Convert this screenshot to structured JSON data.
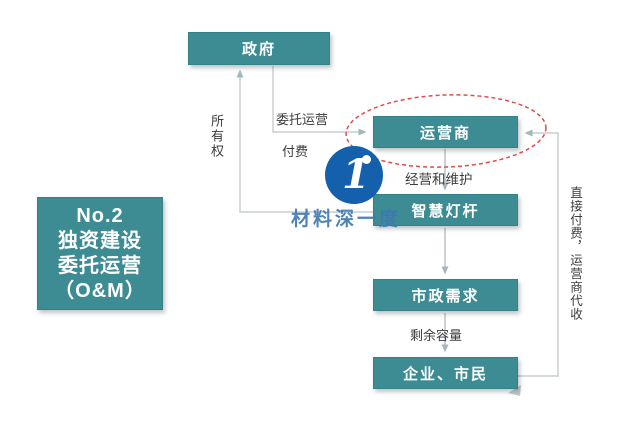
{
  "badge": {
    "line1": "No.2",
    "line2": "独资建设",
    "line3": "委托运营",
    "line4": "（O&M）"
  },
  "nodes": {
    "government": "政府",
    "operator": "运营商",
    "lamppost": "智慧灯杆",
    "municipal": "市政需求",
    "citizens": "企业、市民"
  },
  "edges": {
    "ownership": "所有权",
    "entrust": "委托运营",
    "pay": "付费",
    "operate_maintain": "经营和维护",
    "surplus": "剩余容量",
    "direct_pay": "直接付费，运营商代收"
  },
  "watermark": {
    "logo_glyph": "1",
    "brand_text": "材料深一度"
  },
  "colors": {
    "box_teal": "#3d8c94",
    "connector_gray": "#c7cdcf",
    "arrowhead": "#9fb9bd",
    "highlight_ellipse_red": "#e14b4b",
    "logo_blue": "#1460ad",
    "watermark_blue": "#3e78b0",
    "label_text": "#3d3d3d"
  }
}
